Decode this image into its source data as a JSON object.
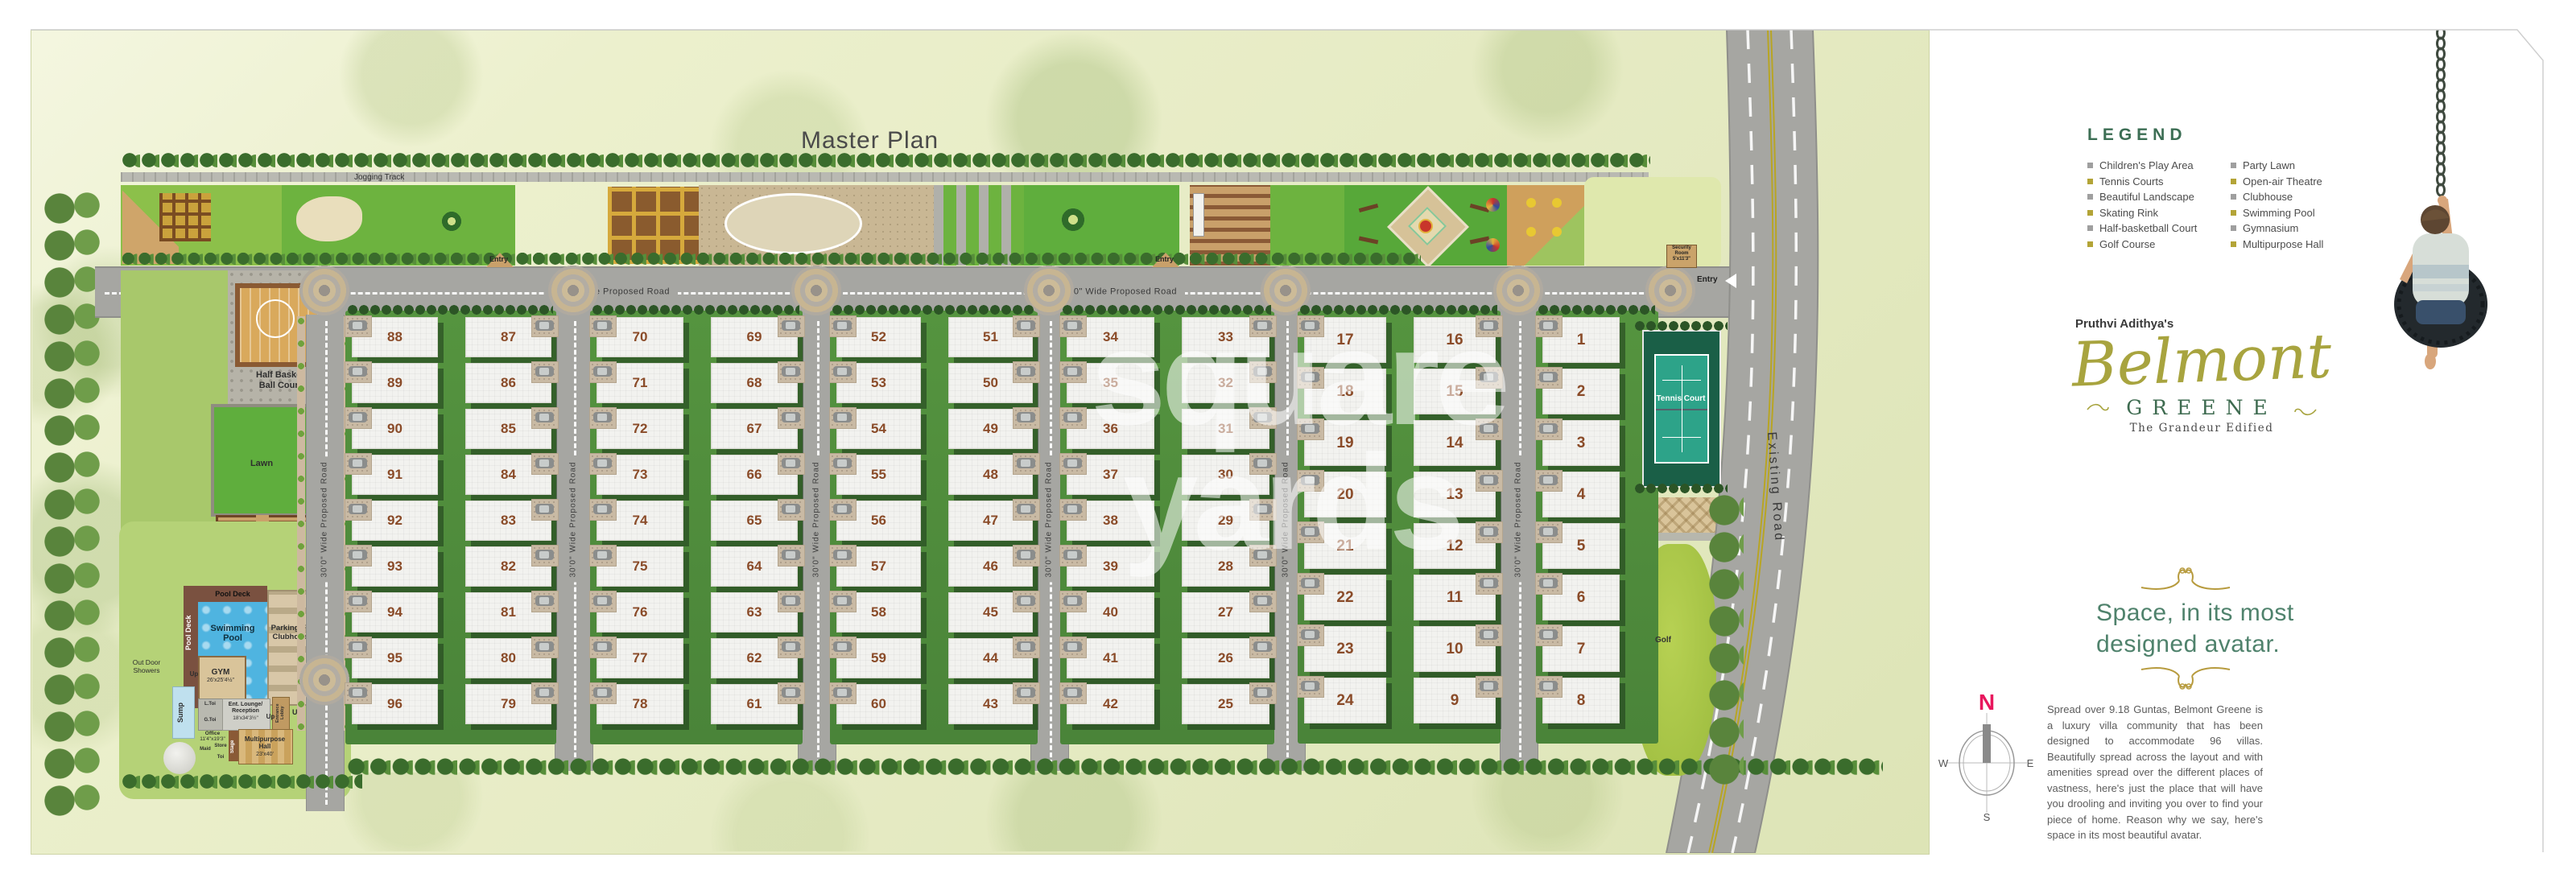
{
  "title": "Master Plan",
  "watermark": {
    "line1": "square",
    "line2": "yards"
  },
  "roads": {
    "main_road_label": "40'0\" Wide Proposed Road",
    "vertical_road_label": "30'0\" Wide Proposed Road",
    "existing_road_label": "Existing Road",
    "entry_label": "Entry"
  },
  "plan": {
    "jogging_track": "Jogging Track",
    "security_room": {
      "l1": "Security",
      "l2": "Room",
      "l3": "5'x11'3\""
    },
    "tennis_court": "Tennis Court",
    "golf": "Golf",
    "lawn": "Lawn",
    "half_basketball": {
      "l1": "Half Basket",
      "l2": "Ball Court"
    },
    "pool_deck": "Pool Deck",
    "swimming_pool": "Swimming Pool",
    "parking": "Parking For Clubhouse",
    "gym": "GYM",
    "gym_dims": "26'x25'4½\"",
    "sump": "Sump",
    "outdoor_showers": "Out Door Showers",
    "up": "Up",
    "l_toi": "L.Toi",
    "g_toi": "G.Toi",
    "ent_lounge": "Ent. Lounge/ Reception",
    "ent_lounge_dims": "18'x34'3½\"",
    "entrance_lobby": "Entrance Lobby",
    "office": "Office",
    "office_dims": "11'4\"x19'3\"",
    "maid": "Maid",
    "store": "Store",
    "toi": "Toi",
    "stage": "Stage",
    "multipurpose": "Multipurpose Hall",
    "multipurpose_dims": "23'x40'",
    "blocks": [
      {
        "left": [
          88,
          89,
          90,
          91,
          92,
          93,
          94,
          95,
          96
        ],
        "right": [
          87,
          86,
          85,
          84,
          83,
          82,
          81,
          80,
          79
        ]
      },
      {
        "left": [
          70,
          71,
          72,
          73,
          74,
          75,
          76,
          77,
          78
        ],
        "right": [
          69,
          68,
          67,
          66,
          65,
          64,
          63,
          62,
          61
        ]
      },
      {
        "left": [
          52,
          53,
          54,
          55,
          56,
          57,
          58,
          59,
          60
        ],
        "right": [
          51,
          50,
          49,
          48,
          47,
          46,
          45,
          44,
          43
        ]
      },
      {
        "left": [
          34,
          35,
          36,
          37,
          38,
          39,
          40,
          41,
          42
        ],
        "right": [
          33,
          32,
          31,
          30,
          29,
          28,
          27,
          26,
          25
        ]
      },
      {
        "left": [
          17,
          18,
          19,
          20,
          21,
          22,
          23,
          24
        ],
        "right": [
          16,
          15,
          14,
          13,
          12,
          11,
          10,
          9
        ]
      },
      {
        "left": [
          1,
          2,
          3,
          4,
          5,
          6,
          7,
          8
        ],
        "right": []
      }
    ]
  },
  "legend": {
    "heading": "LEGEND",
    "columns": [
      [
        {
          "label": "Children's Play Area",
          "bullet": "#9f9f9f"
        },
        {
          "label": "Tennis Courts",
          "bullet": "#b3a437"
        },
        {
          "label": "Beautiful Landscape",
          "bullet": "#9f9f9f"
        },
        {
          "label": "Skating Rink",
          "bullet": "#b3a437"
        },
        {
          "label": "Half-basketball Court",
          "bullet": "#9f9f9f"
        },
        {
          "label": "Golf Course",
          "bullet": "#b3a437"
        }
      ],
      [
        {
          "label": "Party Lawn",
          "bullet": "#9f9f9f"
        },
        {
          "label": "Open-air Theatre",
          "bullet": "#b3a437"
        },
        {
          "label": "Clubhouse",
          "bullet": "#9f9f9f"
        },
        {
          "label": "Swimming Pool",
          "bullet": "#b3a437"
        },
        {
          "label": "Gymnasium",
          "bullet": "#9f9f9f"
        },
        {
          "label": "Multipurpose Hall",
          "bullet": "#b3a437"
        }
      ]
    ]
  },
  "branding": {
    "prefix": "Pruthvi Adithya's",
    "name_script": "Belmont",
    "name_caps": "GREENE",
    "sub": "The Grandeur Edified"
  },
  "headline": {
    "line1": "Space, in its most",
    "line2": "designed avatar."
  },
  "description": "Spread over 9.18 Guntas, Belmont Greene is a luxury villa community that has been designed to accommodate 96 villas. Beautifully spread across the layout and with amenities spread over the different places of vastness, here's just the place that will have you drooling and inviting you over to find your piece of home. Reason why we say, here's space in its most beautiful avatar.",
  "compass": {
    "n": "N",
    "e": "E",
    "s": "S",
    "w": "W"
  },
  "colors": {
    "legend_heading": "#3c6e54",
    "brand_olive": "#a8a43f",
    "brand_green": "#3e6b50",
    "headline_teal": "#4f826c",
    "plot_number": "#8a4b28",
    "road_gray": "#a6a6a2",
    "yellow_line": "#b8a524"
  }
}
